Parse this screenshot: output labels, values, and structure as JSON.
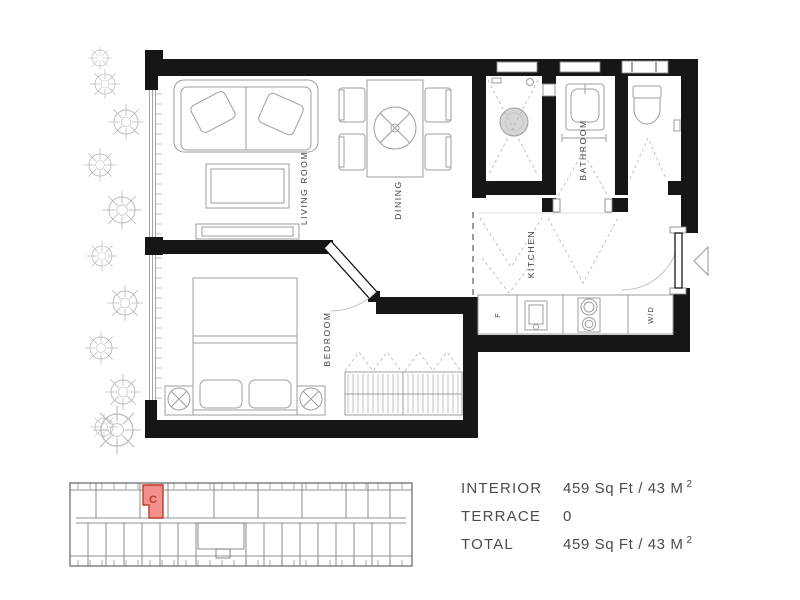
{
  "floor_plan": {
    "labels": {
      "living_room": "LIVING ROOM",
      "dining": "DINING",
      "bedroom": "BEDROOM",
      "kitchen": "KITCHEN",
      "bathroom": "BATHROOM",
      "fridge": "F",
      "washer_dryer": "W/D"
    }
  },
  "key_plan": {
    "highlighted_unit": "C",
    "highlight_fill": "#f2918b",
    "highlight_border": "#c0392b"
  },
  "area_table": {
    "rows": [
      {
        "label": "INTERIOR",
        "value": "459 Sq Ft / 43 M",
        "superscript": "2"
      },
      {
        "label": "TERRACE",
        "value": "0",
        "superscript": ""
      },
      {
        "label": "TOTAL",
        "value": "459 Sq Ft / 43 M",
        "superscript": "2"
      }
    ]
  },
  "colors": {
    "wall": "#161616",
    "furniture": "#9e9e9e",
    "label_text": "#3f3f3f",
    "table_text": "#4b4b4b"
  }
}
